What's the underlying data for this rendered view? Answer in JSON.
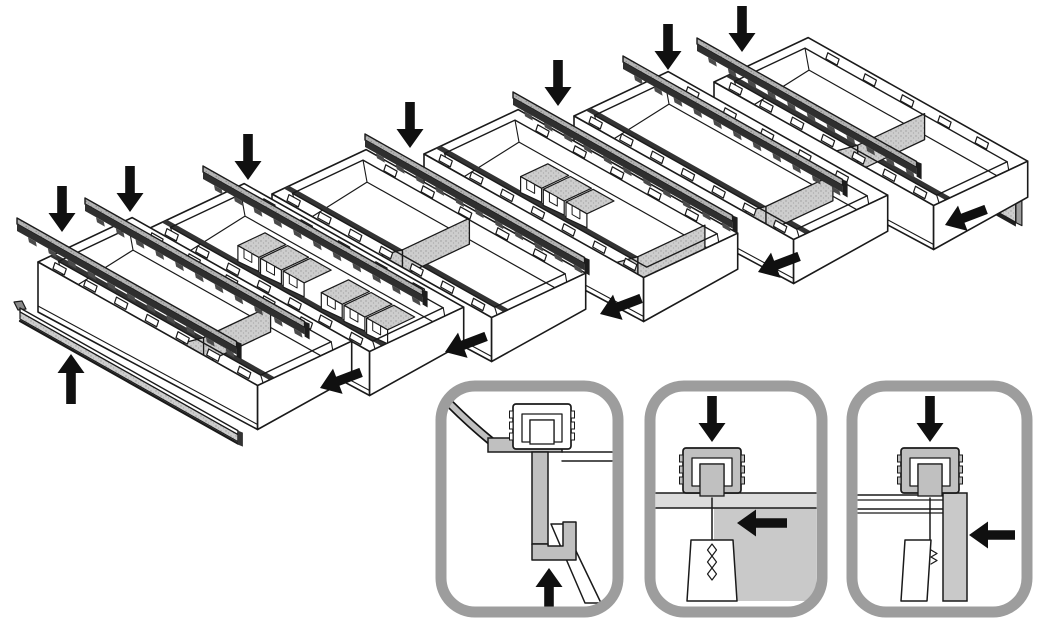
{
  "figure": {
    "type": "technical-assembly-illustration",
    "subject": "drawer-organizer-tray-system-exploded-view"
  },
  "colors": {
    "background": "#ffffff",
    "line": "#1a1a1a",
    "arrow": "#101010",
    "tray_fill": "#ffffff",
    "rail_face": "#2f2f2f",
    "rail_nub": "#4a4a4a",
    "rim_slot_stripe": "#333333",
    "stipple_base": "#cdcdcd",
    "stipple_dot": "#9b9b9b",
    "stipple_dark_base": "#b3b3b3",
    "stipple_dark_dot": "#828282",
    "inset_border": "#9d9d9d",
    "shade_gray": "#c9c9c9",
    "rim_band_gray": "#dcdcdc",
    "profile_gray": "#c0c0c0",
    "panel_edge": "#9c9c9c",
    "flag_gray": "#8a8a8a"
  },
  "main": {
    "trays": [
      {
        "name": "tray-1",
        "origin": [
          38,
          262
        ],
        "divider_t": 0.66,
        "bins": []
      },
      {
        "name": "tray-2",
        "origin": [
          150,
          228
        ],
        "divider_t": null,
        "bins": [
          0.26,
          0.64
        ]
      },
      {
        "name": "tray-3",
        "origin": [
          272,
          194
        ],
        "divider_t": 0.5,
        "bins": []
      },
      {
        "name": "tray-4",
        "origin": [
          424,
          154
        ],
        "divider_t": 0.88,
        "bins": [
          0.3
        ]
      },
      {
        "name": "tray-5",
        "origin": [
          574,
          116
        ],
        "divider_t": 0.78,
        "bins": []
      },
      {
        "name": "tray-6",
        "origin": [
          714,
          82
        ],
        "divider_t": 0.56,
        "bins": []
      }
    ],
    "rails": [
      [
        17,
        218
      ],
      [
        85,
        198
      ],
      [
        203,
        166
      ],
      [
        365,
        134
      ],
      [
        513,
        92
      ],
      [
        623,
        56
      ],
      [
        697,
        38
      ]
    ],
    "rail_length": 252,
    "end_panel": {
      "top_left": [
        798,
        48
      ],
      "length": 250,
      "height": 52,
      "tab_count": 8
    },
    "trim_rail": {
      "start": [
        20,
        308
      ],
      "length": 250
    },
    "arrows": {
      "down": [
        [
          62,
          232
        ],
        [
          130,
          212
        ],
        [
          248,
          180
        ],
        [
          410,
          148
        ],
        [
          558,
          106
        ],
        [
          668,
          70
        ],
        [
          742,
          52
        ]
      ],
      "slide_left": [
        [
          320,
          388
        ],
        [
          445,
          352
        ],
        [
          600,
          314
        ],
        [
          758,
          272
        ],
        [
          945,
          225
        ]
      ],
      "up": [
        [
          71,
          354
        ]
      ]
    }
  },
  "insets": [
    {
      "name": "front-trim-hook-detail",
      "x": 441,
      "y": 386,
      "w": 177,
      "h": 226,
      "arrows": [
        {
          "dir": "up",
          "tip": [
            549,
            568
          ],
          "len": 40
        }
      ]
    },
    {
      "name": "divider-wall-clamp-detail",
      "x": 650,
      "y": 386,
      "w": 172,
      "h": 226,
      "arrows": [
        {
          "dir": "down",
          "tip": [
            712,
            442
          ],
          "len": 46
        },
        {
          "dir": "left",
          "tip": [
            737,
            523
          ],
          "len": 50
        }
      ]
    },
    {
      "name": "side-panel-clamp-detail",
      "x": 852,
      "y": 386,
      "w": 175,
      "h": 226,
      "arrows": [
        {
          "dir": "down",
          "tip": [
            930,
            442
          ],
          "len": 46
        },
        {
          "dir": "left",
          "tip": [
            969,
            535
          ],
          "len": 46
        }
      ]
    }
  ]
}
